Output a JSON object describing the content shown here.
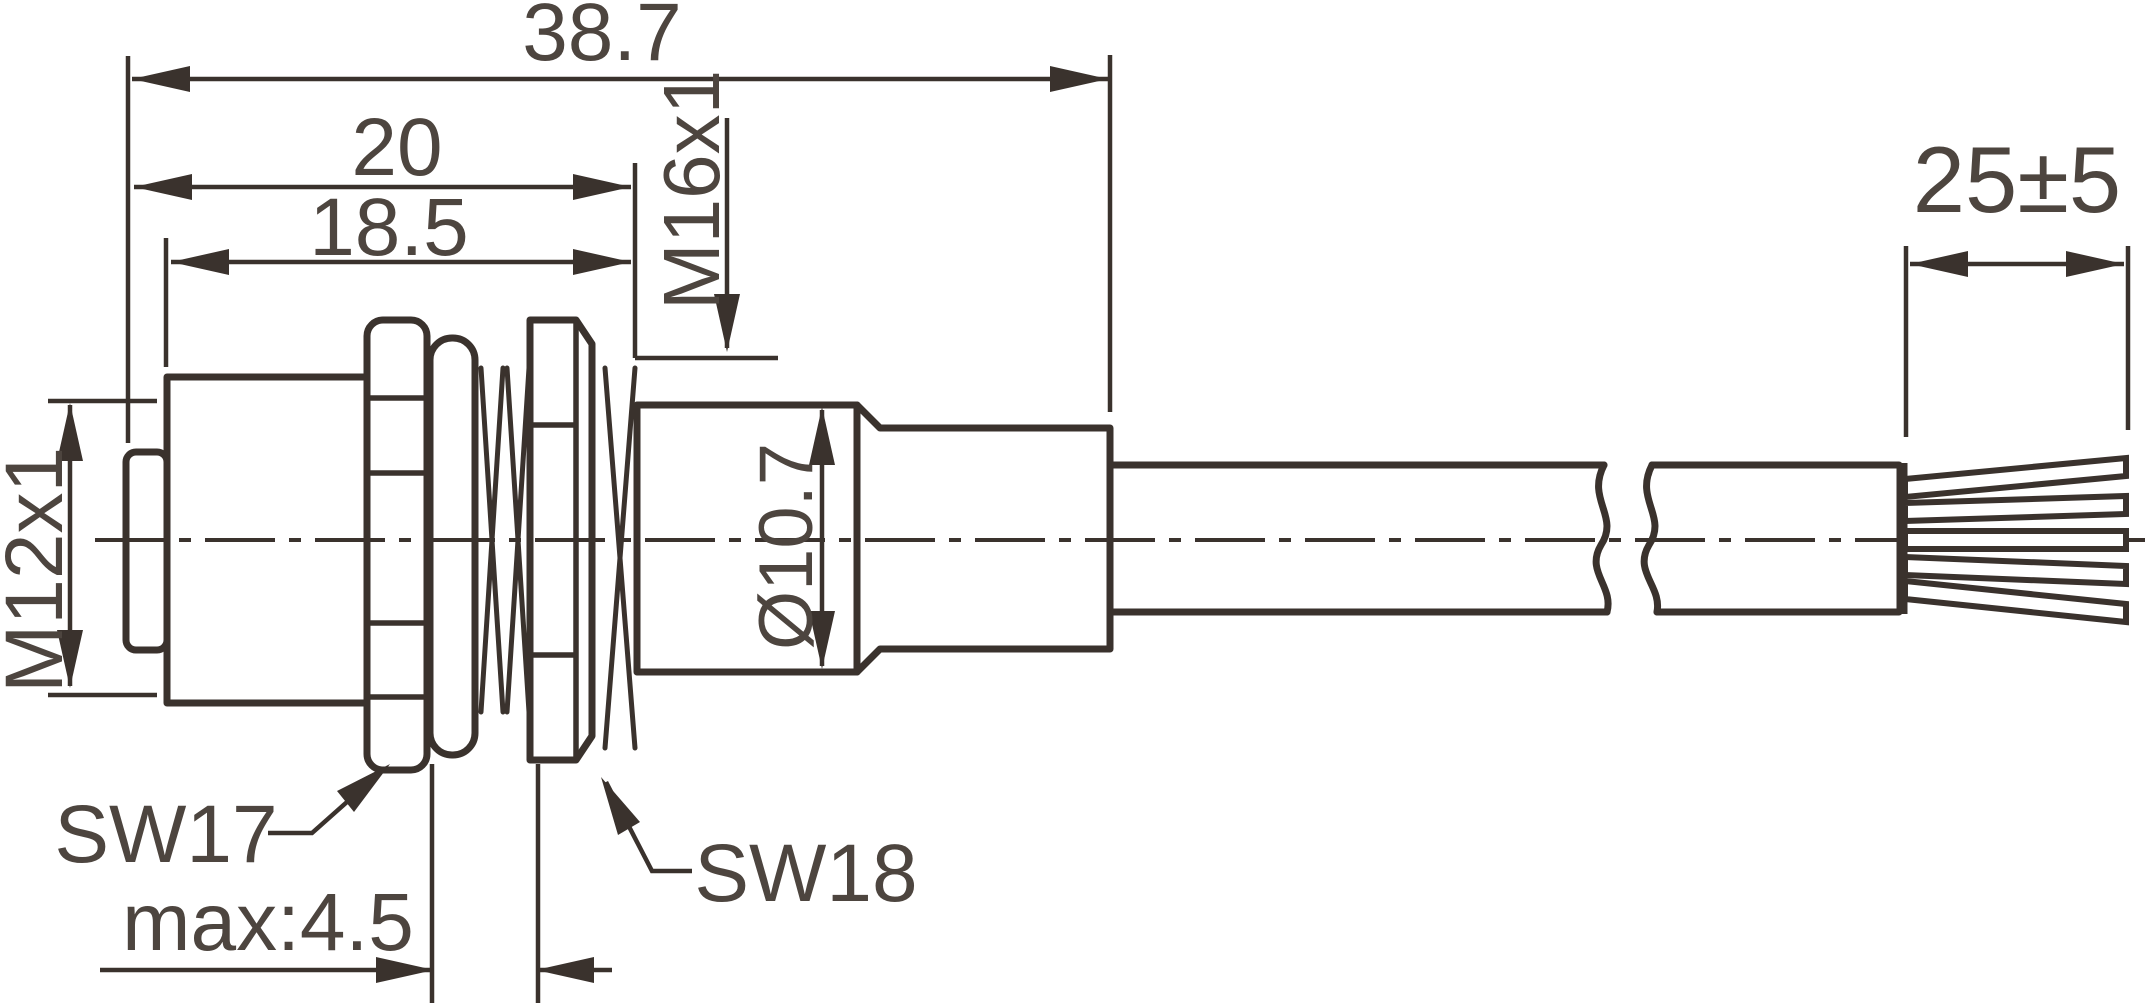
{
  "drawing": {
    "kind": "connector-dimension-drawing",
    "labels": {
      "overall_length": "38.7",
      "upper_length": "20",
      "body_length": "18.5",
      "rear_thread": "M16x1",
      "strip_length": "25±5",
      "front_thread": "M12x1",
      "rear_diameter": "Ø10.7",
      "wrench_front": "SW17",
      "wrench_rear": "SW18",
      "panel_thickness": "max:4.5"
    },
    "colors": {
      "line": "#3a322d",
      "text": "#4d453f",
      "background": "#ffffff"
    }
  }
}
